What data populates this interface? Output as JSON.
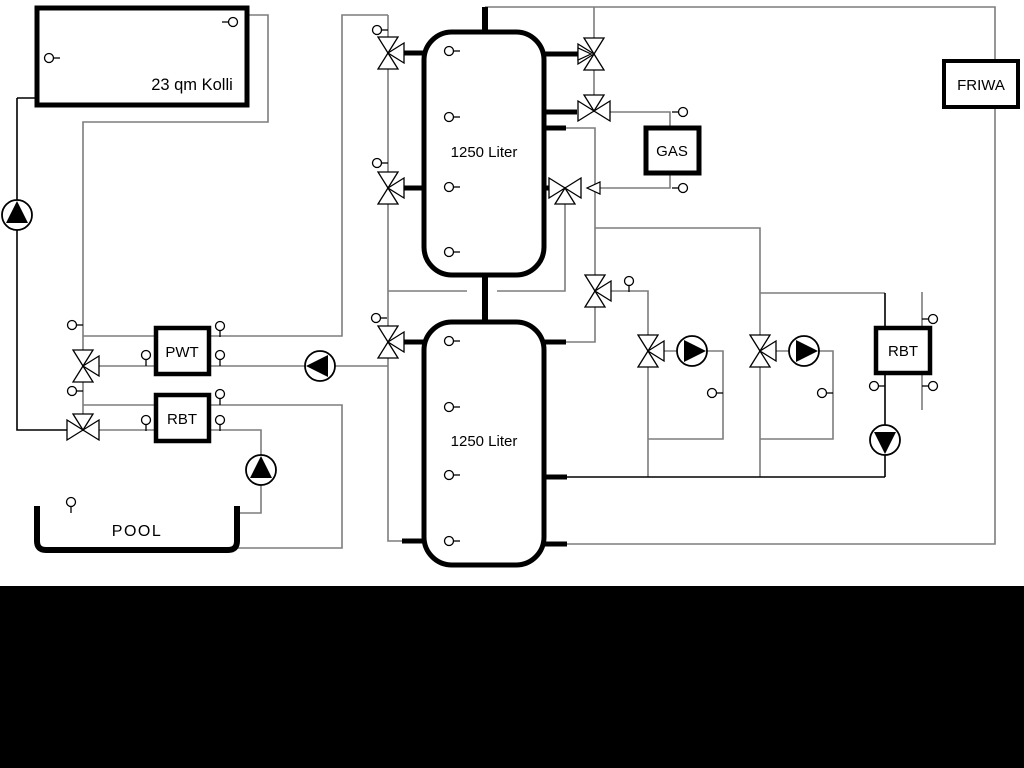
{
  "labels": {
    "collector": "23 qm Kolli",
    "tank1": "1250 Liter",
    "tank2": "1250 Liter",
    "gas": "GAS",
    "friwa": "FRIWA",
    "pwt": "PWT",
    "rbt_left": "RBT",
    "rbt_right": "RBT",
    "pool": "POOL"
  },
  "colors": {
    "pipe_gray": "#7d7d7d",
    "pipe_black": "#000000",
    "component_fill": "#ffffff",
    "canvas_background": "#ffffff",
    "letterbox": "#000000"
  }
}
